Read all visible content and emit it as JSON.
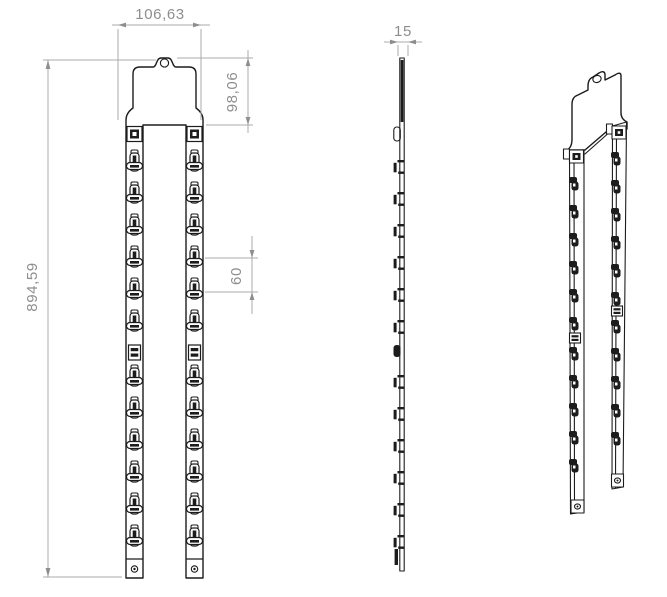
{
  "drawing": {
    "background": "#ffffff",
    "line_color": "#1c1c1c",
    "dim_color": "#8e8e8e",
    "dimensions": {
      "overall_width": "106,63",
      "header_height": "98,06",
      "overall_height": "894,59",
      "hook_pitch": "60",
      "thickness": "15"
    },
    "counts": {
      "strips": 2,
      "hooks_per_strip": 12,
      "views": 3
    }
  }
}
